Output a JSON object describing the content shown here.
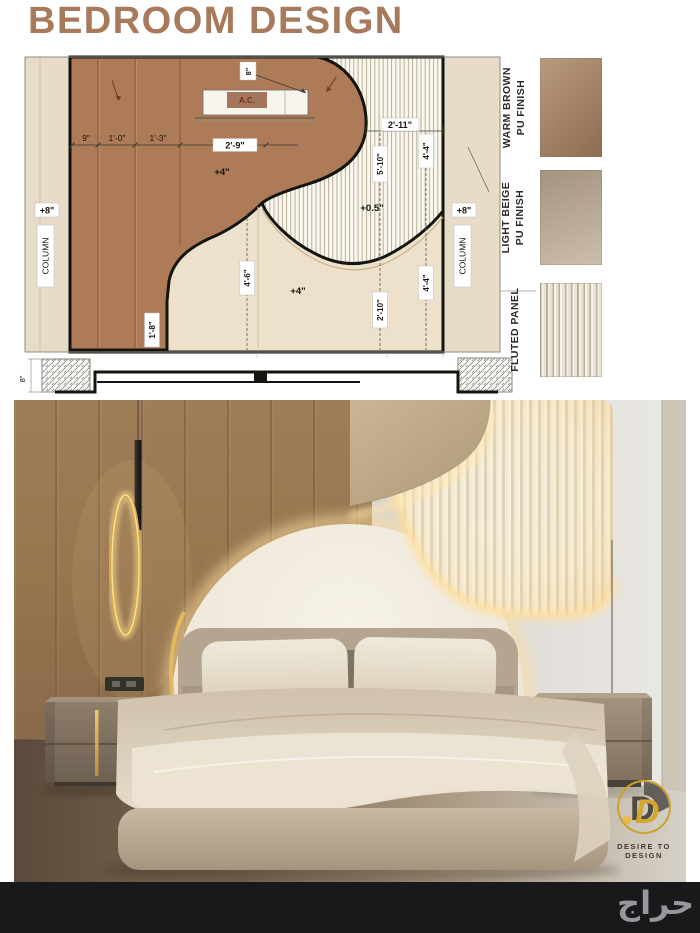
{
  "title": "BEDROOM DESIGN",
  "colors": {
    "title_brown": "#a87a5c",
    "elevation_brown": "#ae7b59",
    "elevation_beige": "#eee1cb",
    "accent_gold": "#d4a94f",
    "footer_bg": "#19181a"
  },
  "elevation": {
    "dims": {
      "d9": "9\"",
      "d1_0": "1'-0\"",
      "d1_3": "1'-3\"",
      "d2_9": "2'-9\"",
      "d2_11": "2'-11\"",
      "d5_10": "5'-10\"",
      "d4_4a": "4'-4\"",
      "d4_4b": "4'-4\"",
      "d4_6": "4'-6\"",
      "d2_10": "2'-10\"",
      "d1_8": "1'-8\"",
      "plus4_upper": "+4\"",
      "plus4_lower": "+4\"",
      "plus05": "+0.5\"",
      "plus8_left": "+8\"",
      "plus8_right": "+8\"",
      "top8": "8\""
    },
    "column_left": "COLUMN",
    "column_right": "COLUMN",
    "ac_label": "A.C.",
    "section_dim": "8\""
  },
  "legend": {
    "items": [
      {
        "line1": "WARM BROWN",
        "line2": "PU FINISH",
        "color": "#a8825e"
      },
      {
        "line1": "LIGHT BEIGE",
        "line2": "PU FINISH",
        "color": "#bdac93"
      },
      {
        "line1": "FLUTED PANEL",
        "line2": "",
        "color": "#e9e2d2"
      }
    ]
  },
  "logo": {
    "brand": "DESIRE TO DESIGN",
    "monogram": "D"
  },
  "footer": {
    "watermark": "حراج"
  }
}
